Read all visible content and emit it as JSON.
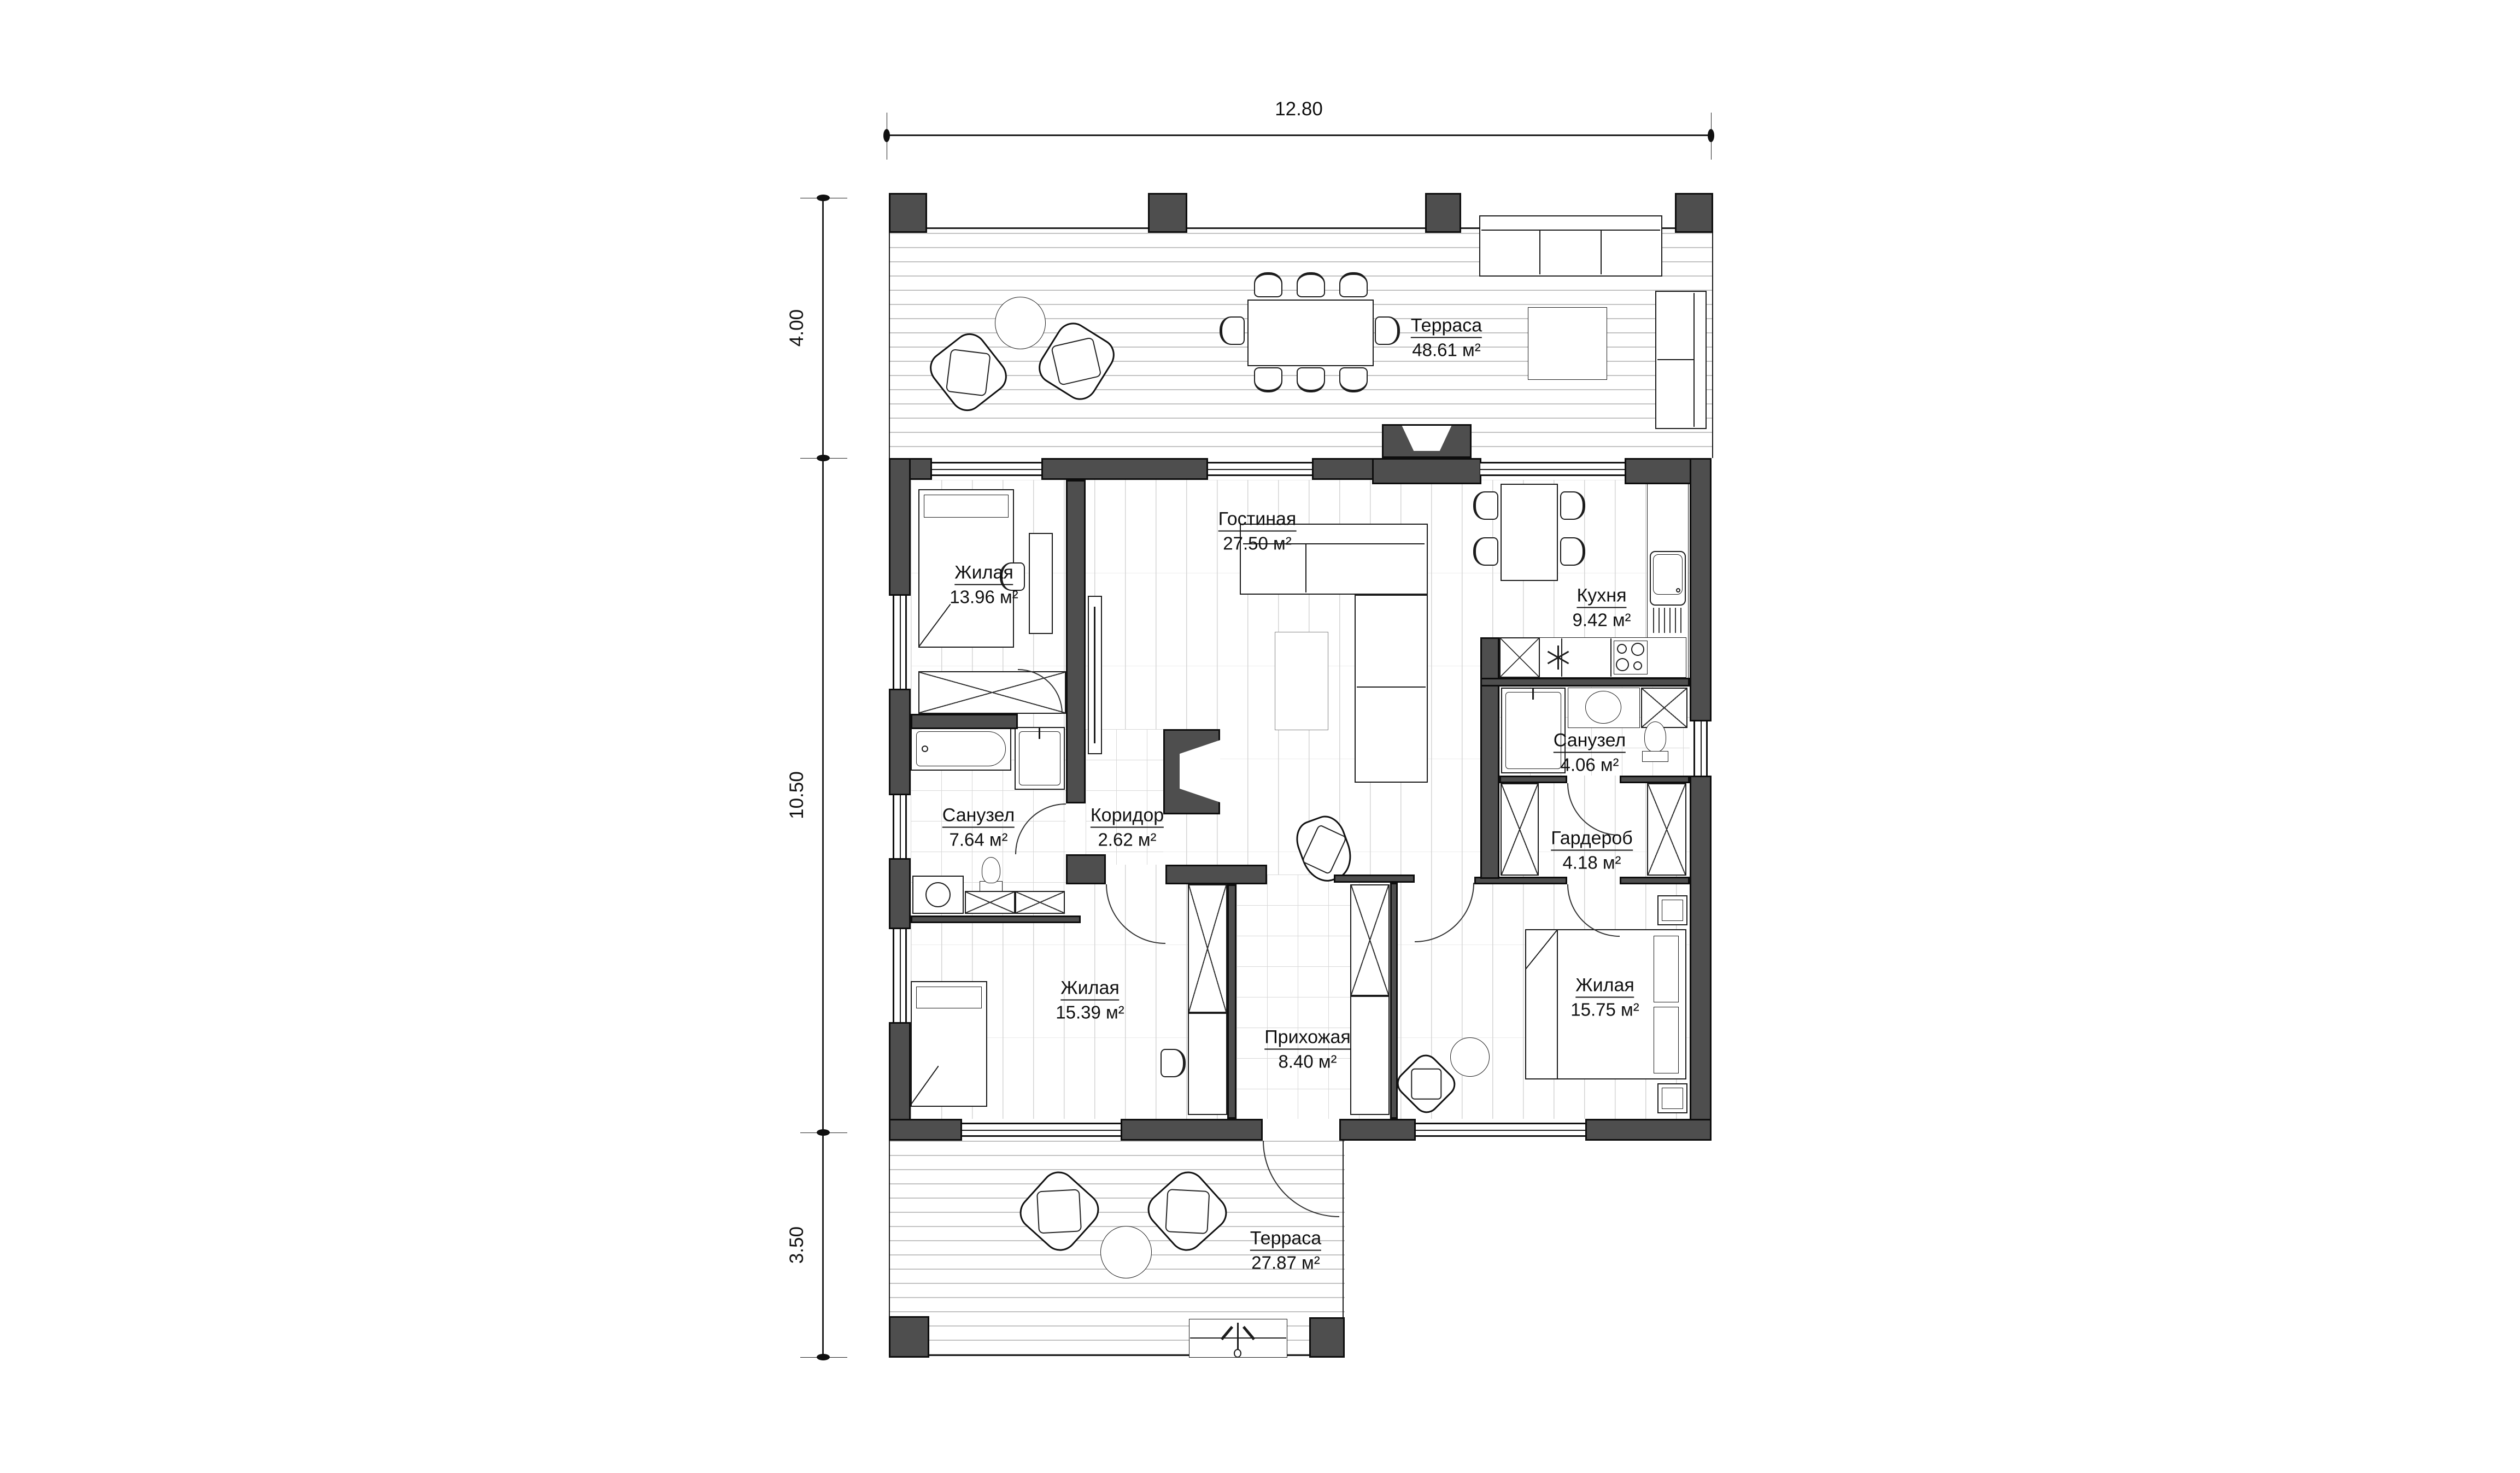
{
  "plan_title": "floor-plan",
  "dimensions": {
    "top_width": "12.80",
    "left_top": "4.00",
    "left_middle": "10.50",
    "left_bottom": "3.50"
  },
  "rooms": [
    {
      "id": "terrace-top",
      "name": "Терраса",
      "area": "48.61 м²"
    },
    {
      "id": "living-room",
      "name": "Гостиная",
      "area": "27.50 м²"
    },
    {
      "id": "bedroom-1",
      "name": "Жилая",
      "area": "13.96 м²"
    },
    {
      "id": "kitchen",
      "name": "Кухня",
      "area": "9.42 м²"
    },
    {
      "id": "bathroom-small",
      "name": "Санузел",
      "area": "4.06 м²"
    },
    {
      "id": "bathroom-large",
      "name": "Санузел",
      "area": "7.64 м²"
    },
    {
      "id": "corridor",
      "name": "Коридор",
      "area": "2.62 м²"
    },
    {
      "id": "wardrobe-room",
      "name": "Гардероб",
      "area": "4.18 м²"
    },
    {
      "id": "bedroom-2",
      "name": "Жилая",
      "area": "15.39 м²"
    },
    {
      "id": "hallway",
      "name": "Прихожая",
      "area": "8.40 м²"
    },
    {
      "id": "bedroom-3",
      "name": "Жилая",
      "area": "15.75 м²"
    },
    {
      "id": "terrace-bottom",
      "name": "Терраса",
      "area": "27.87 м²"
    }
  ],
  "icons": {
    "kitchen_utility": "asterisk-symbol",
    "entry_arrow": "up-arrow"
  },
  "colors": {
    "wall": "#4e4e4e",
    "outline": "#0d0d0d",
    "floor_line": "#d4d4d4"
  }
}
